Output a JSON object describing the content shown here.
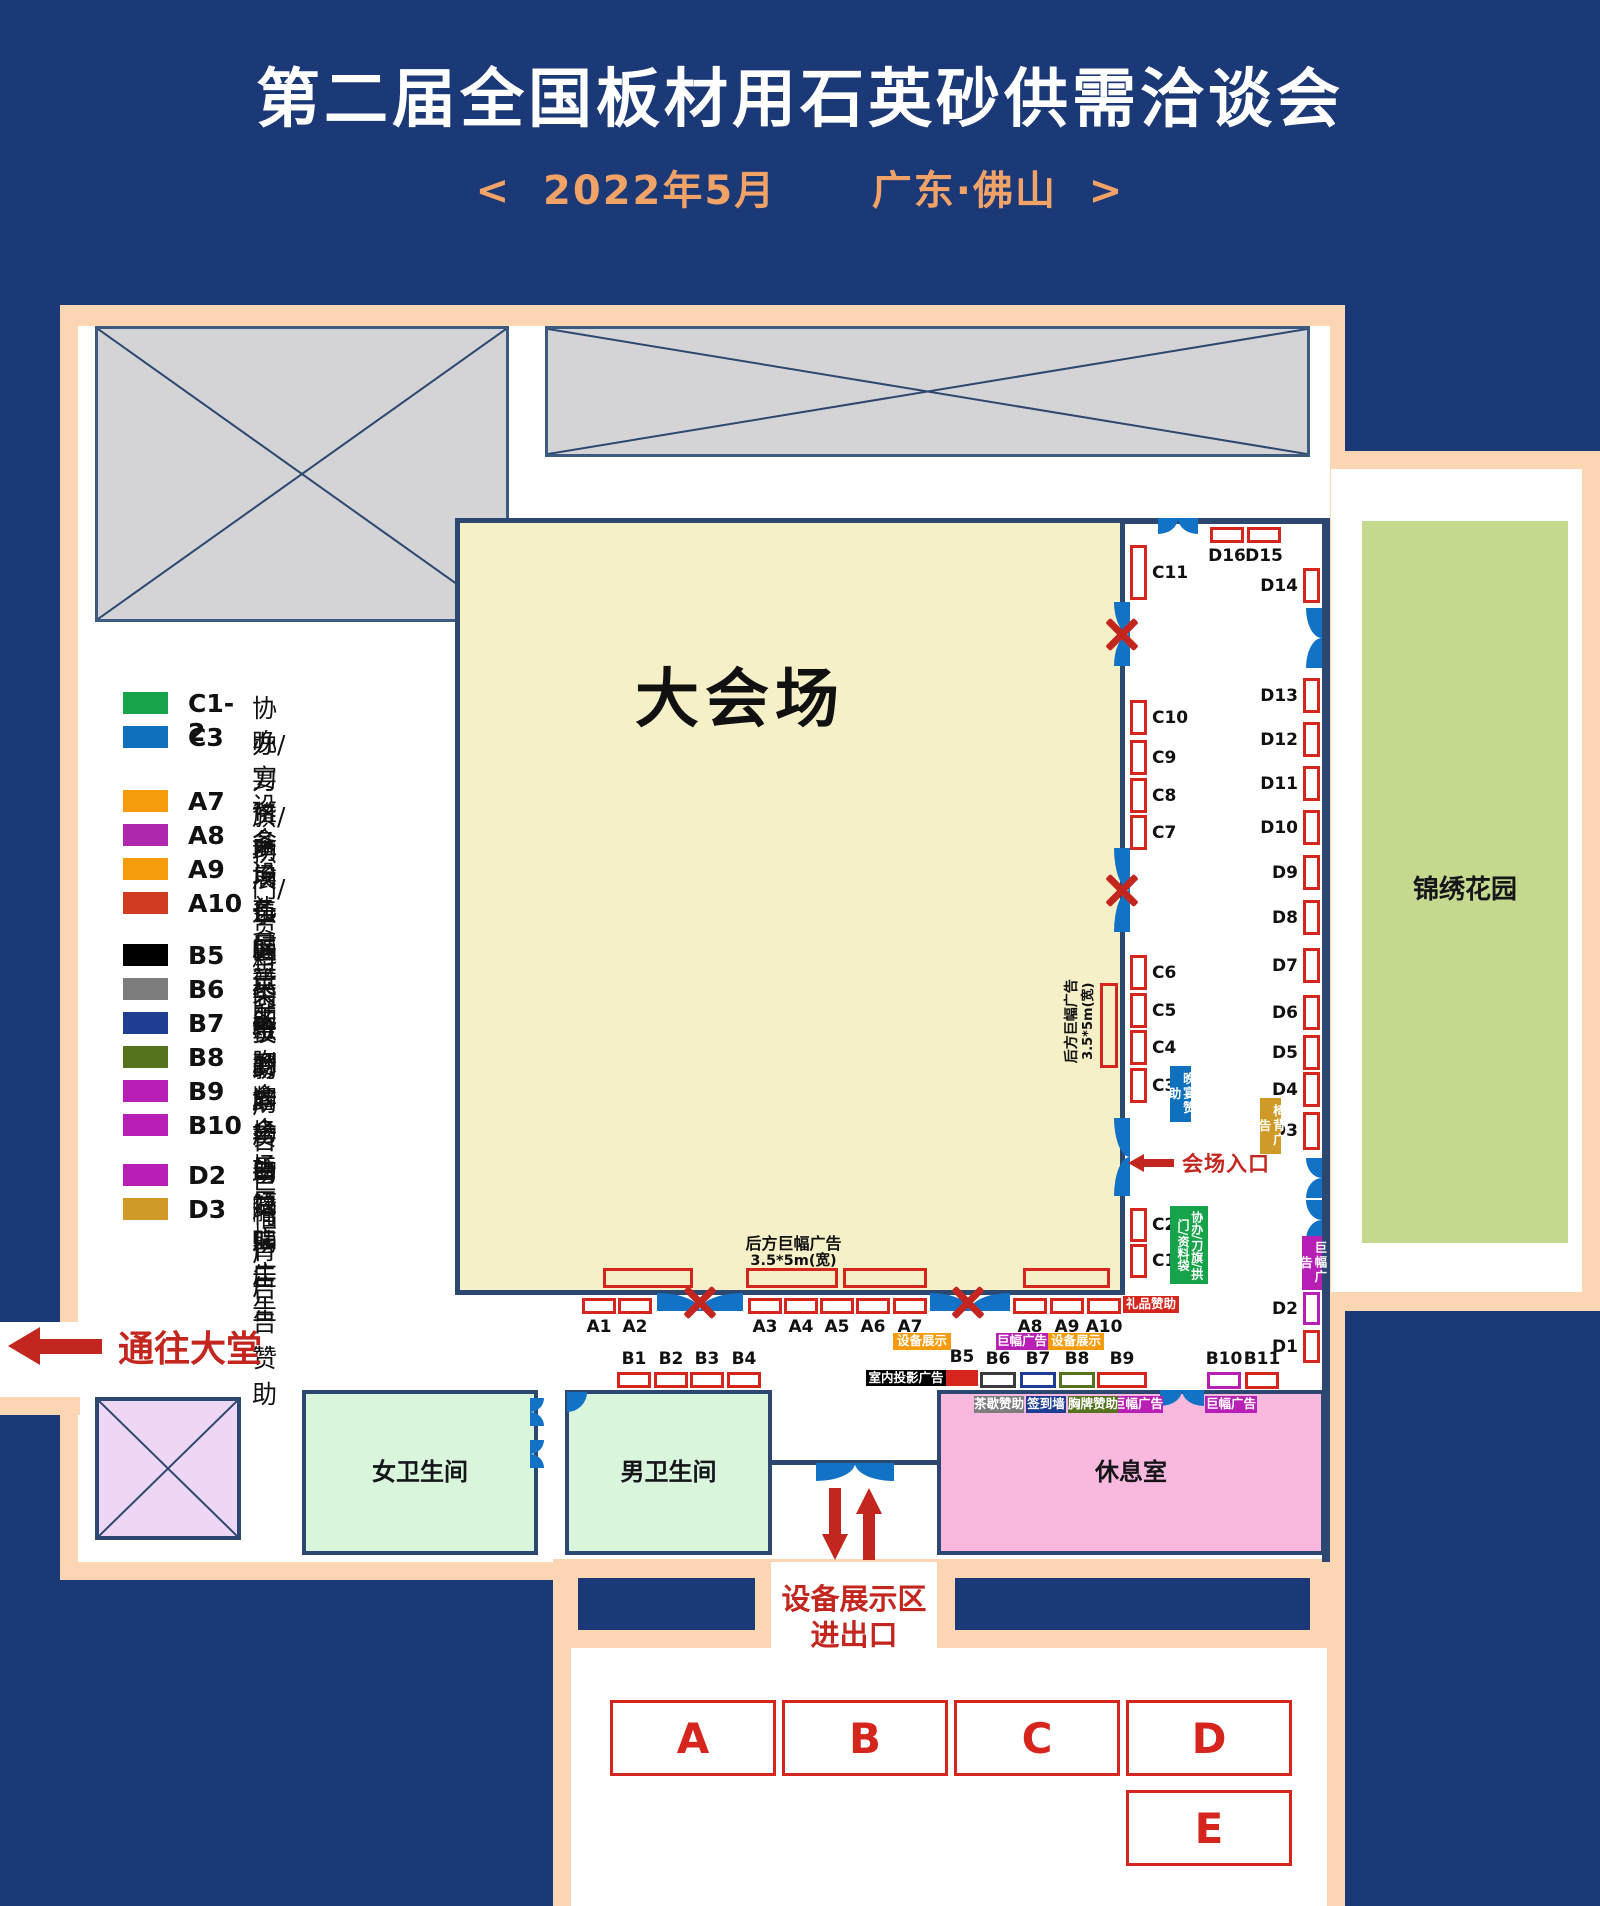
{
  "title": "第二届全国板材用石英砂供需洽谈会",
  "subtitle": "<  2022年5月      广东·佛山  >",
  "colors": {
    "navy_bg": "#1b3877",
    "wall": "#2c4770",
    "peach": "#fcd6b3",
    "booth_red": "#d6251c",
    "door_blue": "#1272c5",
    "arrow_red": "#c3261f",
    "hall_yellow": "#f6f0c8",
    "room_green": "#d9f6dd",
    "lounge_pink": "#f9b9de",
    "garden_green": "#c5d98e",
    "gray_box": "#d4d4d6",
    "lavender": "#eed7f5",
    "green": "#17a349",
    "blue": "#0f71bd",
    "orange": "#f69c0c",
    "magenta": "#b81fb4",
    "purple": "#ae27ad",
    "red": "#d03b21",
    "black": "#000000",
    "gray": "#7d7d7d",
    "navy": "#1d3e92",
    "olive": "#55731d",
    "gold": "#d09a28"
  },
  "legend": [
    {
      "code": "C1-2",
      "label": "协办/刀旗/拱门/资料袋赞助",
      "color": "#17a349",
      "y": 692
    },
    {
      "code": "C3",
      "label": "晚宴赞助",
      "color": "#0f71bd",
      "y": 726
    },
    {
      "code": "A7",
      "label": "设备展示区",
      "color": "#f69c0c",
      "y": 790
    },
    {
      "code": "A8",
      "label": "会场巨幅广告",
      "color": "#ae27ad",
      "y": 824
    },
    {
      "code": "A9",
      "label": "设备展示区",
      "color": "#f69c0c",
      "y": 858
    },
    {
      "code": "A10",
      "label": "礼品赞助",
      "color": "#d03b21",
      "y": 892
    },
    {
      "code": "B5",
      "label": "室内投影广告",
      "color": "#000000",
      "y": 944
    },
    {
      "code": "B6",
      "label": "茶歇赞助",
      "color": "#7d7d7d",
      "y": 978
    },
    {
      "code": "B7",
      "label": "签到墙赞助",
      "color": "#1d3e92",
      "y": 1012
    },
    {
      "code": "B8",
      "label": "胸牌广告赞助",
      "color": "#55731d",
      "y": 1046
    },
    {
      "code": "B9",
      "label": "会场巨幅广告",
      "color": "#b81fb4",
      "y": 1080
    },
    {
      "code": "B10",
      "label": "会场巨幅广告",
      "color": "#b81fb4",
      "y": 1114
    },
    {
      "code": "D2",
      "label": "巨幅广告",
      "color": "#b81fb4",
      "y": 1164
    },
    {
      "code": "D3",
      "label": "椅背广告赞助",
      "color": "#d09a28",
      "y": 1198
    }
  ],
  "map": {
    "hall_label": "大会场",
    "garden_label": "锦绣花园",
    "rooms": {
      "women": "女卫生间",
      "men": "男卫生间",
      "lounge": "休息室"
    },
    "lobby_label": "通往大堂",
    "entrance_label": "会场入口",
    "equipment_line1": "设备展示区",
    "equipment_line2": "进出口",
    "banner_text": {
      "line1": "后方巨幅广告",
      "line2": "3.5*5m(宽)"
    },
    "zones": [
      {
        "label": "A",
        "x": 610,
        "y": 1700,
        "w": 166,
        "h": 76
      },
      {
        "label": "B",
        "x": 782,
        "y": 1700,
        "w": 166,
        "h": 76
      },
      {
        "label": "C",
        "x": 954,
        "y": 1700,
        "w": 166,
        "h": 76
      },
      {
        "label": "D",
        "x": 1126,
        "y": 1700,
        "w": 166,
        "h": 76
      },
      {
        "label": "E",
        "x": 1126,
        "y": 1790,
        "w": 166,
        "h": 76
      }
    ],
    "booths": [
      {
        "id": "A1",
        "x": 582,
        "y": 1298,
        "w": 34,
        "h": 16,
        "side": "below"
      },
      {
        "id": "A2",
        "x": 618,
        "y": 1298,
        "w": 34,
        "h": 16,
        "side": "below"
      },
      {
        "id": "A3",
        "x": 748,
        "y": 1298,
        "w": 34,
        "h": 16,
        "side": "below"
      },
      {
        "id": "A4",
        "x": 784,
        "y": 1298,
        "w": 34,
        "h": 16,
        "side": "below"
      },
      {
        "id": "A5",
        "x": 820,
        "y": 1298,
        "w": 34,
        "h": 16,
        "side": "below"
      },
      {
        "id": "A6",
        "x": 856,
        "y": 1298,
        "w": 34,
        "h": 16,
        "side": "below"
      },
      {
        "id": "A7",
        "x": 893,
        "y": 1298,
        "w": 34,
        "h": 16,
        "side": "below"
      },
      {
        "id": "A8",
        "x": 1013,
        "y": 1298,
        "w": 34,
        "h": 16,
        "side": "below"
      },
      {
        "id": "A9",
        "x": 1050,
        "y": 1298,
        "w": 34,
        "h": 16,
        "side": "below"
      },
      {
        "id": "A10",
        "x": 1087,
        "y": 1298,
        "w": 34,
        "h": 16,
        "side": "below"
      },
      {
        "id": "B1",
        "x": 617,
        "y": 1372,
        "w": 34,
        "h": 16,
        "side": "above"
      },
      {
        "id": "B2",
        "x": 654,
        "y": 1372,
        "w": 34,
        "h": 16,
        "side": "above"
      },
      {
        "id": "B3",
        "x": 690,
        "y": 1372,
        "w": 34,
        "h": 16,
        "side": "above"
      },
      {
        "id": "B4",
        "x": 727,
        "y": 1372,
        "w": 34,
        "h": 16,
        "side": "above"
      },
      {
        "id": "B5",
        "x": 946,
        "y": 1370,
        "w": 32,
        "h": 16,
        "side": "above",
        "fill": "#d6251c"
      },
      {
        "id": "B6",
        "x": 980,
        "y": 1372,
        "w": 36,
        "h": 16,
        "side": "above",
        "border": "#3a3a3a"
      },
      {
        "id": "B7",
        "x": 1020,
        "y": 1372,
        "w": 36,
        "h": 16,
        "side": "above",
        "border": "#1d3e92"
      },
      {
        "id": "B8",
        "x": 1059,
        "y": 1372,
        "w": 36,
        "h": 16,
        "side": "above",
        "border": "#55731d"
      },
      {
        "id": "B9",
        "x": 1097,
        "y": 1372,
        "w": 50,
        "h": 16,
        "side": "above"
      },
      {
        "id": "B10",
        "x": 1207,
        "y": 1372,
        "w": 34,
        "h": 17,
        "side": "above",
        "border": "#b81fb4"
      },
      {
        "id": "B11",
        "x": 1245,
        "y": 1372,
        "w": 34,
        "h": 17,
        "side": "above"
      },
      {
        "id": "C11",
        "x": 1130,
        "y": 545,
        "w": 17,
        "h": 55,
        "side": "right"
      },
      {
        "id": "C10",
        "x": 1130,
        "y": 700,
        "w": 17,
        "h": 35,
        "side": "right"
      },
      {
        "id": "C9",
        "x": 1130,
        "y": 740,
        "w": 17,
        "h": 35,
        "side": "right"
      },
      {
        "id": "C8",
        "x": 1130,
        "y": 778,
        "w": 17,
        "h": 35,
        "side": "right"
      },
      {
        "id": "C7",
        "x": 1130,
        "y": 815,
        "w": 17,
        "h": 35,
        "side": "right"
      },
      {
        "id": "C6",
        "x": 1130,
        "y": 955,
        "w": 17,
        "h": 35,
        "side": "right"
      },
      {
        "id": "C5",
        "x": 1130,
        "y": 993,
        "w": 17,
        "h": 35,
        "side": "right"
      },
      {
        "id": "C4",
        "x": 1130,
        "y": 1030,
        "w": 17,
        "h": 35,
        "side": "right"
      },
      {
        "id": "C3",
        "x": 1130,
        "y": 1068,
        "w": 17,
        "h": 35,
        "side": "right"
      },
      {
        "id": "C2",
        "x": 1130,
        "y": 1208,
        "w": 17,
        "h": 34,
        "side": "right"
      },
      {
        "id": "C1",
        "x": 1130,
        "y": 1244,
        "w": 17,
        "h": 34,
        "side": "right"
      },
      {
        "id": "D16",
        "x": 1210,
        "y": 527,
        "w": 34,
        "h": 16,
        "side": "below"
      },
      {
        "id": "D15",
        "x": 1247,
        "y": 527,
        "w": 34,
        "h": 16,
        "side": "below"
      },
      {
        "id": "D14",
        "x": 1303,
        "y": 568,
        "w": 17,
        "h": 35,
        "side": "left"
      },
      {
        "id": "D13",
        "x": 1303,
        "y": 678,
        "w": 17,
        "h": 35,
        "side": "left"
      },
      {
        "id": "D12",
        "x": 1303,
        "y": 722,
        "w": 17,
        "h": 35,
        "side": "left"
      },
      {
        "id": "D11",
        "x": 1303,
        "y": 766,
        "w": 17,
        "h": 35,
        "side": "left"
      },
      {
        "id": "D10",
        "x": 1303,
        "y": 810,
        "w": 17,
        "h": 35,
        "side": "left"
      },
      {
        "id": "D9",
        "x": 1303,
        "y": 855,
        "w": 17,
        "h": 35,
        "side": "left"
      },
      {
        "id": "D8",
        "x": 1303,
        "y": 900,
        "w": 17,
        "h": 35,
        "side": "left"
      },
      {
        "id": "D7",
        "x": 1303,
        "y": 948,
        "w": 17,
        "h": 35,
        "side": "left"
      },
      {
        "id": "D6",
        "x": 1303,
        "y": 995,
        "w": 17,
        "h": 35,
        "side": "left"
      },
      {
        "id": "D5",
        "x": 1303,
        "y": 1035,
        "w": 17,
        "h": 35,
        "side": "left"
      },
      {
        "id": "D4",
        "x": 1303,
        "y": 1072,
        "w": 17,
        "h": 35,
        "side": "left"
      },
      {
        "id": "D3",
        "x": 1303,
        "y": 1112,
        "w": 17,
        "h": 38,
        "side": "left"
      },
      {
        "id": "D2",
        "x": 1303,
        "y": 1292,
        "w": 17,
        "h": 33,
        "side": "left",
        "border": "#b81fb4"
      },
      {
        "id": "D1",
        "x": 1303,
        "y": 1330,
        "w": 17,
        "h": 33,
        "side": "left"
      }
    ],
    "tags": [
      {
        "text": "设备展示",
        "x": 893,
        "y": 1333,
        "w": 58,
        "h": 17,
        "bg": "#f69c0c",
        "mode": "h"
      },
      {
        "text": "设备展示",
        "x": 1048,
        "y": 1333,
        "w": 56,
        "h": 17,
        "bg": "#f69c0c",
        "mode": "h"
      },
      {
        "text": "巨幅广告",
        "x": 996,
        "y": 1333,
        "w": 52,
        "h": 17,
        "bg": "#b81fb4",
        "mode": "h"
      },
      {
        "text": "巨幅广告",
        "x": 1113,
        "y": 1396,
        "w": 50,
        "h": 17,
        "bg": "#b81fb4",
        "mode": "h"
      },
      {
        "text": "巨幅广告",
        "x": 1205,
        "y": 1396,
        "w": 52,
        "h": 17,
        "bg": "#b81fb4",
        "mode": "h"
      },
      {
        "text": "巨幅广告",
        "x": 1302,
        "y": 1236,
        "w": 20,
        "h": 54,
        "bg": "#b81fb4",
        "mode": "v"
      },
      {
        "text": "礼品赞助",
        "x": 1123,
        "y": 1296,
        "w": 56,
        "h": 17,
        "bg": "#d6251c",
        "mode": "h"
      },
      {
        "text": "室内投影广告",
        "x": 866,
        "y": 1370,
        "w": 80,
        "h": 16,
        "bg": "#000000",
        "mode": "h"
      },
      {
        "text": "茶歇赞助",
        "x": 974,
        "y": 1396,
        "w": 50,
        "h": 17,
        "bg": "#7d7d7d",
        "mode": "h"
      },
      {
        "text": "签到墙",
        "x": 1026,
        "y": 1396,
        "w": 40,
        "h": 17,
        "bg": "#1d3e92",
        "mode": "h"
      },
      {
        "text": "胸牌赞助",
        "x": 1068,
        "y": 1396,
        "w": 50,
        "h": 17,
        "bg": "#55731d",
        "mode": "h"
      },
      {
        "text": "晚宴赞助",
        "x": 1170,
        "y": 1066,
        "w": 21,
        "h": 56,
        "bg": "#0f71bd",
        "mode": "v"
      },
      {
        "text": "椅背广告",
        "x": 1260,
        "y": 1098,
        "w": 21,
        "h": 56,
        "bg": "#d09a28",
        "mode": "v"
      },
      {
        "text": "协办/刀旗/拱门/资料袋",
        "x": 1170,
        "y": 1206,
        "w": 38,
        "h": 78,
        "bg": "#17a349",
        "mode": "v2"
      }
    ],
    "banners": [
      {
        "x": 603,
        "y": 1268,
        "w": 90,
        "h": 20
      },
      {
        "x": 746,
        "y": 1268,
        "w": 92,
        "h": 20
      },
      {
        "x": 843,
        "y": 1268,
        "w": 84,
        "h": 20
      },
      {
        "x": 1023,
        "y": 1268,
        "w": 87,
        "h": 20
      },
      {
        "x": 1100,
        "y": 983,
        "w": 18,
        "h": 85
      }
    ],
    "doors": [
      {
        "x": 1158,
        "y": 518,
        "w": 40,
        "h": 16,
        "o": "down"
      },
      {
        "x": 1114,
        "y": 602,
        "w": 16,
        "h": 64,
        "o": "left"
      },
      {
        "x": 1114,
        "y": 848,
        "w": 16,
        "h": 84,
        "o": "left"
      },
      {
        "x": 1114,
        "y": 1118,
        "w": 16,
        "h": 78,
        "o": "left"
      },
      {
        "x": 1306,
        "y": 608,
        "w": 16,
        "h": 60,
        "o": "left"
      },
      {
        "x": 1306,
        "y": 1158,
        "w": 16,
        "h": 40,
        "o": "left"
      },
      {
        "x": 1306,
        "y": 1200,
        "w": 16,
        "h": 40,
        "o": "left"
      },
      {
        "x": 657,
        "y": 1293,
        "w": 86,
        "h": 18,
        "o": "up"
      },
      {
        "x": 930,
        "y": 1293,
        "w": 80,
        "h": 18,
        "o": "up"
      },
      {
        "x": 1160,
        "y": 1390,
        "w": 44,
        "h": 16,
        "o": "down"
      },
      {
        "x": 816,
        "y": 1463,
        "w": 78,
        "h": 18,
        "o": "down"
      },
      {
        "x": 530,
        "y": 1398,
        "w": 14,
        "h": 28,
        "o": "right"
      },
      {
        "x": 530,
        "y": 1440,
        "w": 14,
        "h": 28,
        "o": "right"
      },
      {
        "x": 567,
        "y": 1392,
        "w": 20,
        "h": 20,
        "o": "wedge"
      }
    ],
    "xmarks": [
      {
        "cx": 1122,
        "cy": 634
      },
      {
        "cx": 1122,
        "cy": 890
      },
      {
        "cx": 700,
        "cy": 1302
      },
      {
        "cx": 968,
        "cy": 1302
      }
    ]
  }
}
